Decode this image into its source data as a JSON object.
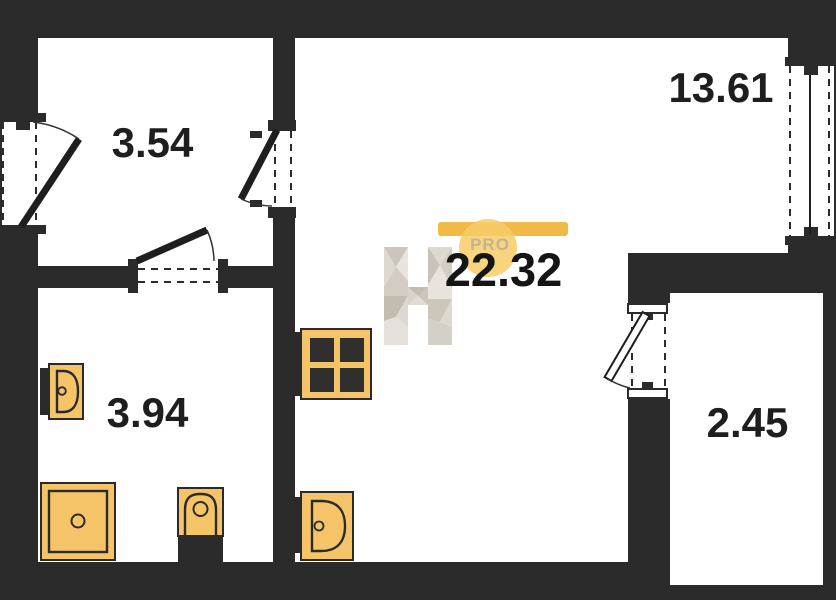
{
  "plan": {
    "type": "apartment-floor-plan",
    "room_labels": {
      "hallway_area": "3.54",
      "bathroom_area": "3.94",
      "living_room_area": "13.61",
      "total_area": "22.32",
      "balcony_area": "2.45"
    },
    "watermark": {
      "letter": "H",
      "badge": "PRO"
    },
    "fixtures": [
      "washbasin",
      "shower-tray",
      "toilet",
      "stove-4-burner",
      "kitchen-sink"
    ],
    "openings": [
      "entrance-door-left-wall",
      "hallway-to-living-door",
      "hallway-to-bathroom-door",
      "balcony-door",
      "window-right-wall"
    ],
    "colors": {
      "wall": "#2b2b2b",
      "background": "#ffffff",
      "fixture_fill": "#f6c468",
      "fixture_outline": "#2b2b2b",
      "logo_bar": "#f1b945",
      "logo_circle": "#f7cd69",
      "logo_text": "#c4b38f",
      "label_text": "#1e1e1e",
      "watermark_gray": "#d5d0c7"
    }
  }
}
